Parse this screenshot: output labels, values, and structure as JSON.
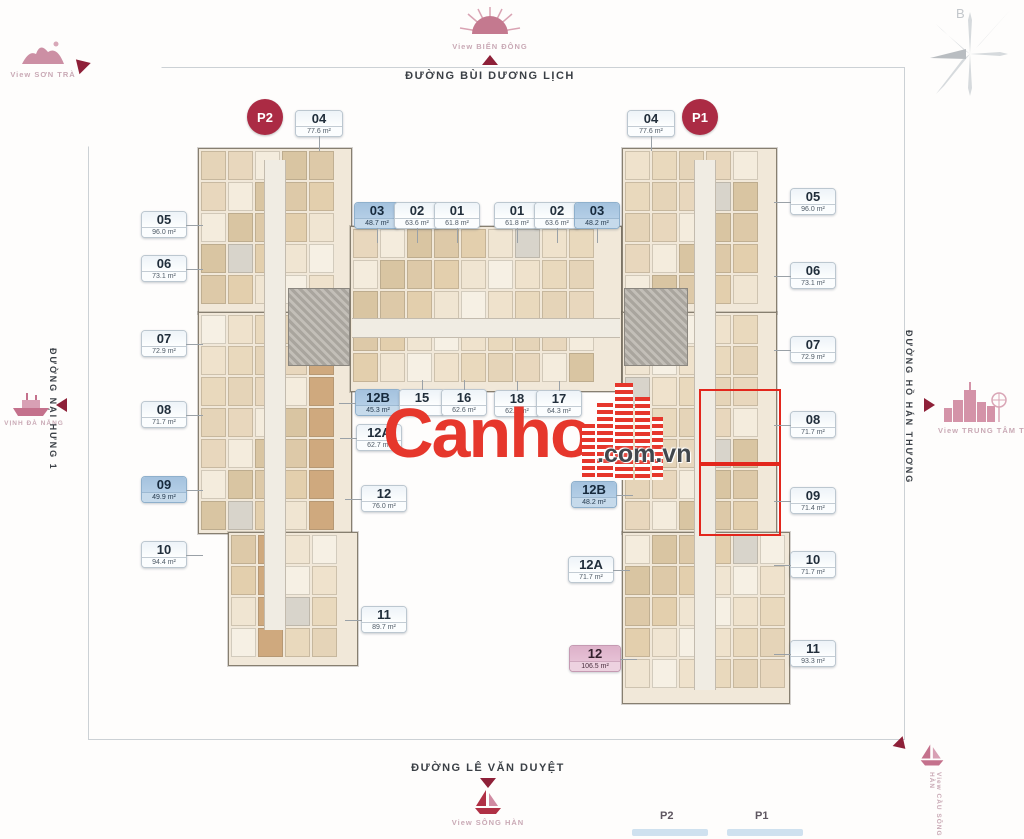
{
  "brand": {
    "name": "Canho",
    "suffix": ".com.vn"
  },
  "compass": {
    "north_label": "B"
  },
  "streets": {
    "top": "ĐƯỜNG BÙI DƯƠNG LỊCH",
    "left": "ĐƯỜNG NẠI HƯNG 1",
    "right": "ĐƯỜNG HỒ HÁN THƯƠNG",
    "bottom": "ĐƯỜNG LÊ VĂN DUYỆT"
  },
  "views": {
    "sea": "View BIỂN ĐÔNG",
    "son_tra": "View SƠN TRÀ",
    "bay": "VỊNH ĐÀ NẴNG",
    "city": "View TRUNG TÂM THÀNH PHỐ",
    "river": "View SÔNG HÀN",
    "bridge": "View CẦU SÔNG HÀN"
  },
  "markers": {
    "p2": "P2",
    "p1": "P1"
  },
  "legend": {
    "p2": "P2",
    "p1": "P1"
  },
  "units": [
    {
      "no": "04",
      "area": "77.6 m²",
      "x": 295,
      "y": 110,
      "v": "plain",
      "leader": "down",
      "w": 46
    },
    {
      "no": "04",
      "area": "77.6 m²",
      "x": 627,
      "y": 110,
      "v": "plain",
      "leader": "down",
      "w": 46
    },
    {
      "no": "03",
      "area": "48.7 m²",
      "x": 354,
      "y": 202,
      "v": "blue",
      "leader": "down"
    },
    {
      "no": "02",
      "area": "63.6 m²",
      "x": 394,
      "y": 202,
      "v": "plain",
      "leader": "down"
    },
    {
      "no": "01",
      "area": "61.8 m²",
      "x": 434,
      "y": 202,
      "v": "plain",
      "leader": "down"
    },
    {
      "no": "01",
      "area": "61.8 m²",
      "x": 494,
      "y": 202,
      "v": "plain",
      "leader": "down"
    },
    {
      "no": "02",
      "area": "63.6 m²",
      "x": 534,
      "y": 202,
      "v": "plain",
      "leader": "down"
    },
    {
      "no": "03",
      "area": "48.2 m²",
      "x": 574,
      "y": 202,
      "v": "blue",
      "leader": "down"
    },
    {
      "no": "05",
      "area": "96.0 m²",
      "x": 141,
      "y": 211,
      "v": "plain",
      "leader": "right"
    },
    {
      "no": "06",
      "area": "73.1 m²",
      "x": 141,
      "y": 255,
      "v": "plain",
      "leader": "right"
    },
    {
      "no": "07",
      "area": "72.9 m²",
      "x": 141,
      "y": 330,
      "v": "plain",
      "leader": "right"
    },
    {
      "no": "08",
      "area": "71.7 m²",
      "x": 141,
      "y": 401,
      "v": "plain",
      "leader": "right"
    },
    {
      "no": "09",
      "area": "49.9 m²",
      "x": 141,
      "y": 476,
      "v": "blue",
      "leader": "right"
    },
    {
      "no": "10",
      "area": "94.4 m²",
      "x": 141,
      "y": 541,
      "v": "plain",
      "leader": "right"
    },
    {
      "no": "12B",
      "area": "45.3 m²",
      "x": 355,
      "y": 389,
      "v": "blue",
      "leader": "left"
    },
    {
      "no": "15",
      "area": "",
      "x": 399,
      "y": 389,
      "v": "plain",
      "leader": "up"
    },
    {
      "no": "16",
      "area": "62.6 m²",
      "x": 441,
      "y": 389,
      "v": "plain",
      "leader": "up"
    },
    {
      "no": "18",
      "area": "62.6 m²",
      "x": 494,
      "y": 390,
      "v": "plain",
      "leader": "up"
    },
    {
      "no": "17",
      "area": "64.3 m²",
      "x": 536,
      "y": 390,
      "v": "plain",
      "leader": "up"
    },
    {
      "no": "12A",
      "area": "62.7 m²",
      "x": 356,
      "y": 424,
      "v": "plain",
      "leader": "left"
    },
    {
      "no": "12",
      "area": "76.0 m²",
      "x": 361,
      "y": 485,
      "v": "plain",
      "leader": "left"
    },
    {
      "no": "11",
      "area": "89.7 m²",
      "x": 361,
      "y": 606,
      "v": "plain",
      "leader": "left"
    },
    {
      "no": "12B",
      "area": "48.2 m²",
      "x": 571,
      "y": 481,
      "v": "blue",
      "leader": "right"
    },
    {
      "no": "12A",
      "area": "71.7 m²",
      "x": 568,
      "y": 556,
      "v": "plain",
      "leader": "right"
    },
    {
      "no": "12",
      "area": "106.5 m²",
      "x": 569,
      "y": 645,
      "v": "pink",
      "leader": "right",
      "w": 50
    },
    {
      "no": "05",
      "area": "96.0 m²",
      "x": 790,
      "y": 188,
      "v": "plain",
      "leader": "left"
    },
    {
      "no": "06",
      "area": "73.1 m²",
      "x": 790,
      "y": 262,
      "v": "plain",
      "leader": "left"
    },
    {
      "no": "07",
      "area": "72.9 m²",
      "x": 790,
      "y": 336,
      "v": "plain",
      "leader": "left"
    },
    {
      "no": "08",
      "area": "71.7 m²",
      "x": 790,
      "y": 411,
      "v": "plain",
      "leader": "left"
    },
    {
      "no": "09",
      "area": "71.4 m²",
      "x": 790,
      "y": 487,
      "v": "plain",
      "leader": "left"
    },
    {
      "no": "10",
      "area": "71.7 m²",
      "x": 790,
      "y": 551,
      "v": "plain",
      "leader": "left"
    },
    {
      "no": "11",
      "area": "93.3 m²",
      "x": 790,
      "y": 640,
      "v": "plain",
      "leader": "left"
    }
  ]
}
